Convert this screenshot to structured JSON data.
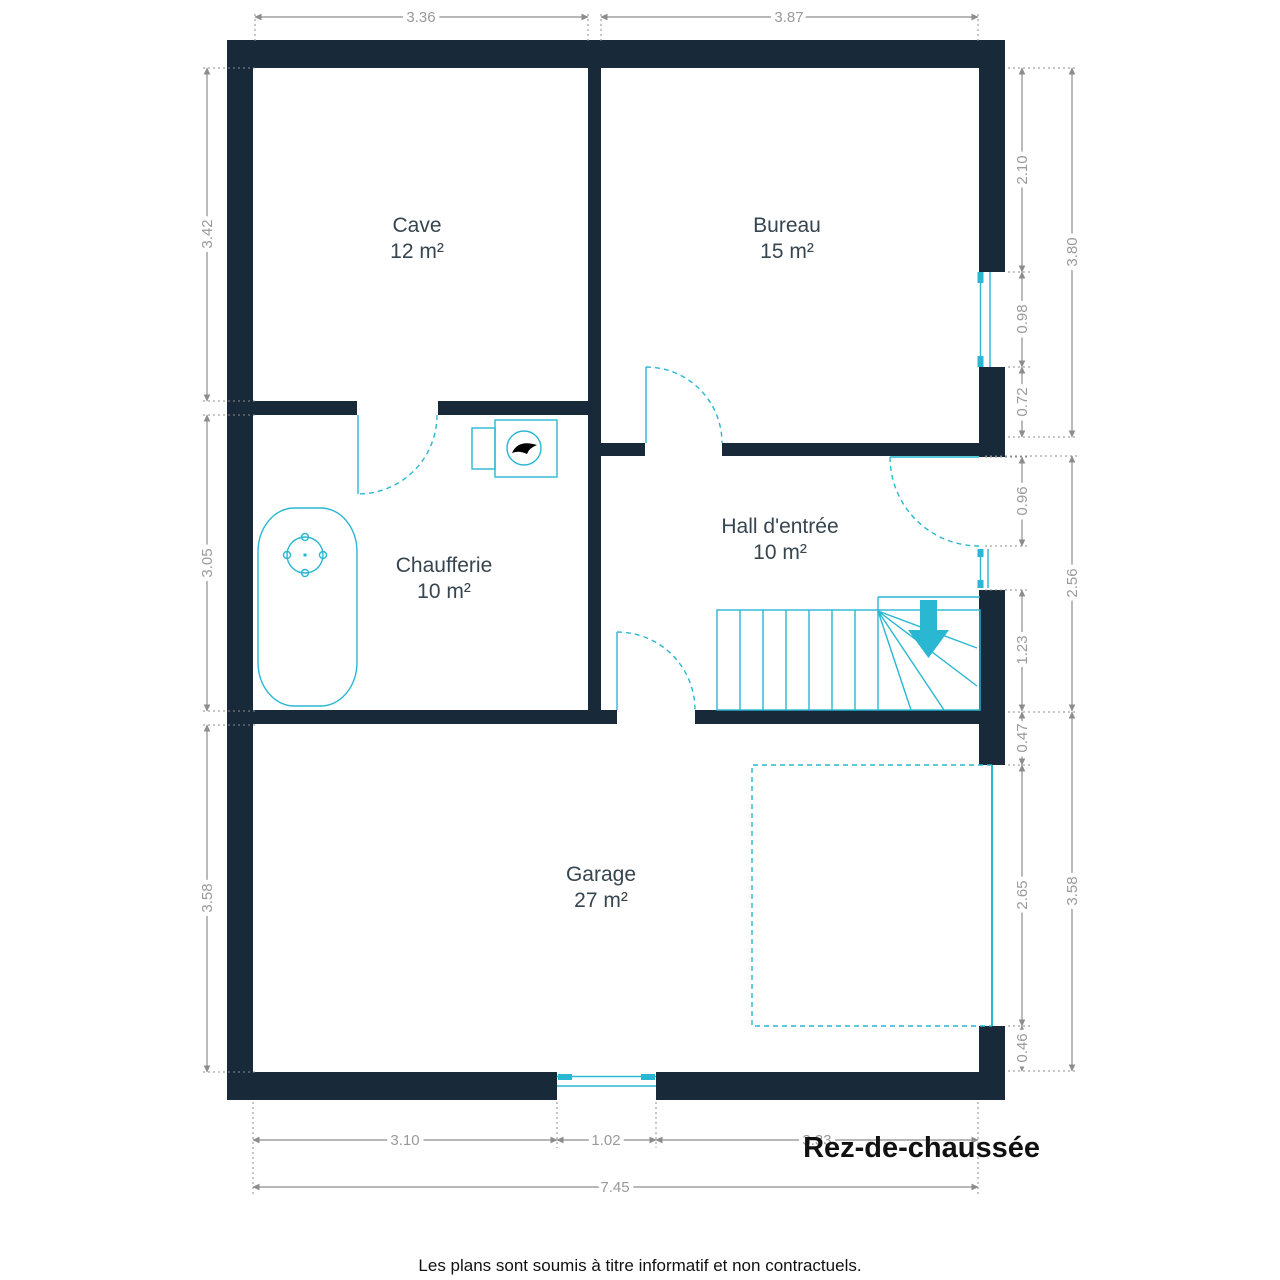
{
  "plan": {
    "title": "Rez-de-chaussée",
    "disclaimer": "Les plans sont soumis à titre informatif et non contractuels.",
    "rooms": [
      {
        "name": "Cave",
        "area": "12 m²"
      },
      {
        "name": "Bureau",
        "area": "15 m²"
      },
      {
        "name": "Chaufferie",
        "area": "10 m²"
      },
      {
        "name": "Hall d'entrée",
        "area": "10 m²"
      },
      {
        "name": "Garage",
        "area": "27 m²"
      }
    ],
    "dimensions": {
      "top": [
        "3.36",
        "3.87"
      ],
      "left": [
        "3.42",
        "3.05",
        "3.58"
      ],
      "right_inner": [
        "2.10",
        "0.98",
        "0.72",
        "0.96",
        "1.23",
        "0.47",
        "2.65",
        "0.46"
      ],
      "right_outer": [
        "3.80",
        "2.56",
        "3.58"
      ],
      "bottom": [
        "3.10",
        "1.02",
        "3.33"
      ],
      "bottom_total": "7.45"
    },
    "colors": {
      "wall": "#18293a",
      "fixture": "#29b7d2",
      "dimension_line": "#8d8d8d",
      "dimension_text": "#9a9a9a",
      "room_text": "#36454f",
      "title_text": "#111111"
    }
  }
}
